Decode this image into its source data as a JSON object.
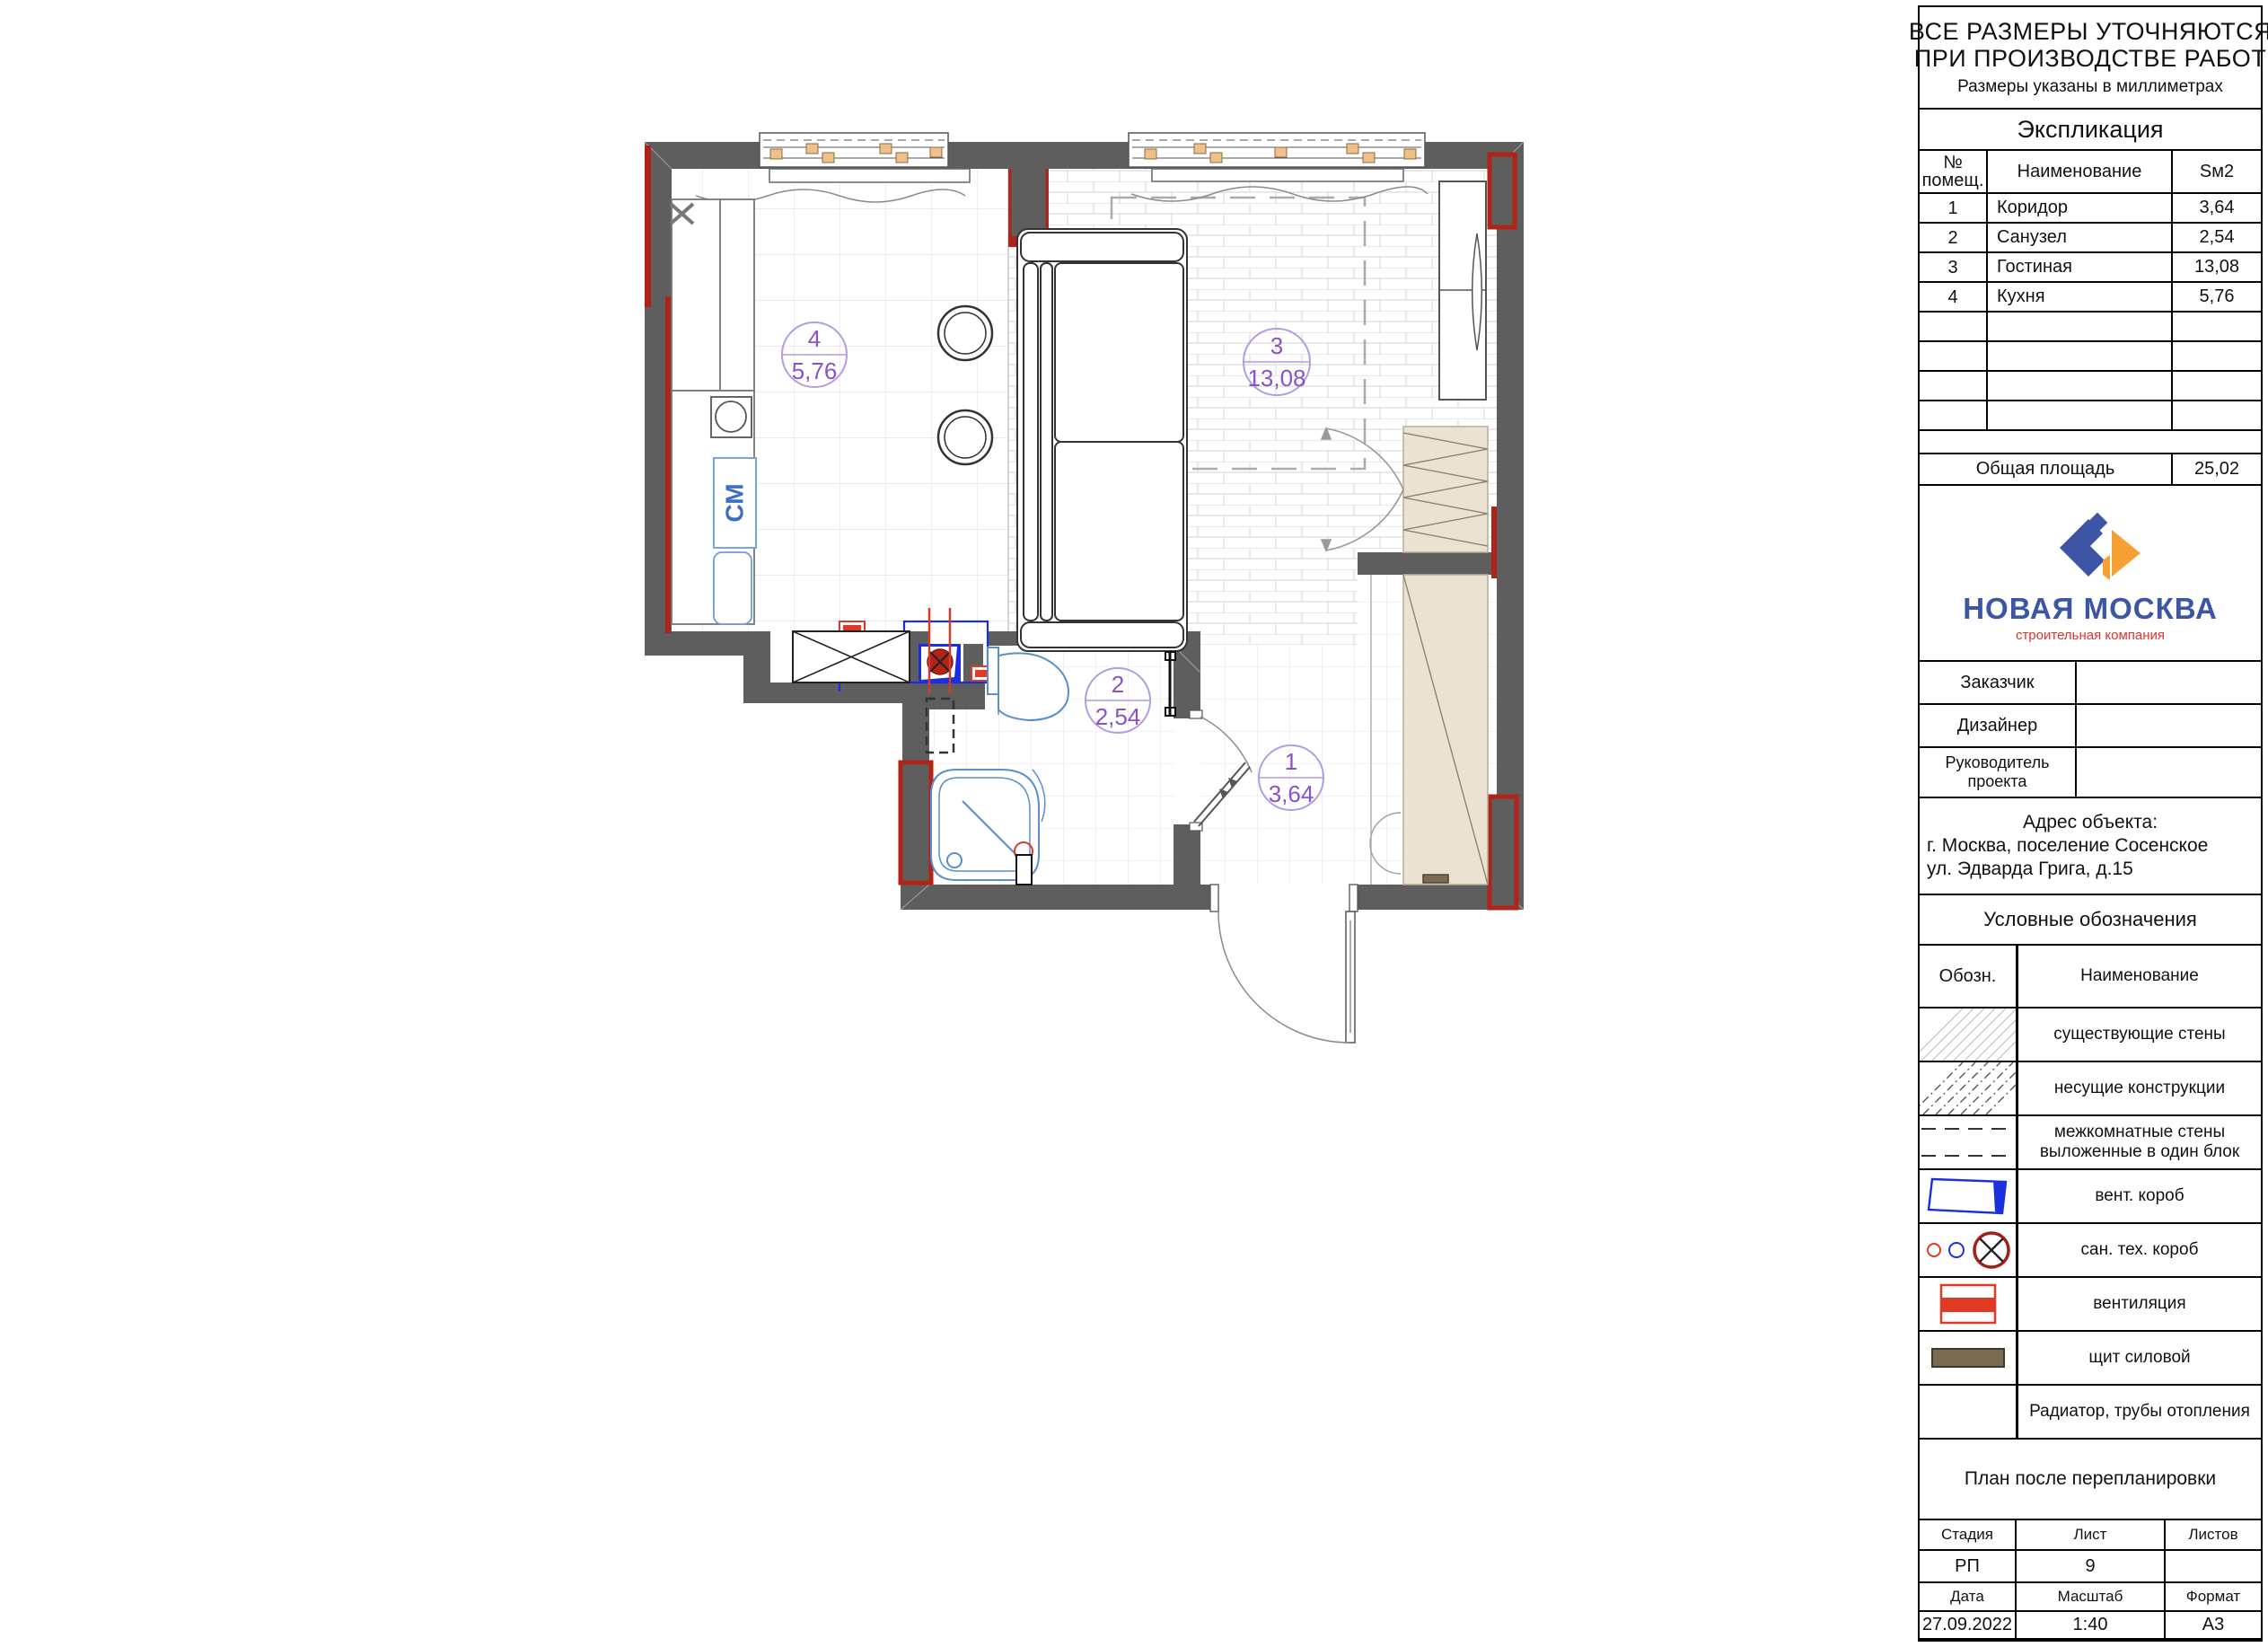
{
  "notice": {
    "line1": "ВСЕ РАЗМЕРЫ УТОЧНЯЮТСЯ",
    "line2": "ПРИ ПРОИЗВОДСТВЕ РАБОТ",
    "subtitle": "Размеры указаны в миллиметрах"
  },
  "explication": {
    "title": "Экспликация",
    "col_num_line1": "№",
    "col_num_line2": "помещ.",
    "col_name": "Наименование",
    "col_area": "Sм2",
    "rows": [
      {
        "num": "1",
        "name": "Коридор",
        "area": "3,64"
      },
      {
        "num": "2",
        "name": "Санузел",
        "area": "2,54"
      },
      {
        "num": "3",
        "name": "Гостиная",
        "area": "13,08"
      },
      {
        "num": "4",
        "name": "Кухня",
        "area": "5,76"
      }
    ],
    "total_label": "Общая площадь",
    "total_value": "25,02"
  },
  "logo": {
    "name": "НОВАЯ МОСКВА",
    "tagline": "строительная компания"
  },
  "form": {
    "customer_label": "Заказчик",
    "designer_label": "Дизайнер",
    "manager_label_line1": "Руководитель",
    "manager_label_line2": "проекта"
  },
  "address": {
    "title": "Адрес объекта:",
    "line1": "г. Москва, поселение Сосенское",
    "line2": "ул. Эдварда Грига, д.15"
  },
  "legend": {
    "title": "Условные обозначения",
    "col_symbol": "Обозн.",
    "col_name": "Наименование",
    "items": [
      {
        "label": "существующие стены"
      },
      {
        "label": "несущие конструкции"
      },
      {
        "label": "межкомнатные стены выложенные в один блок"
      },
      {
        "label": "вент. короб"
      },
      {
        "label": "сан. тех. короб"
      },
      {
        "label": "вентиляция"
      },
      {
        "label": "щит силовой"
      },
      {
        "label": "Радиатор, трубы отопления"
      }
    ]
  },
  "sheet": {
    "plan_title": "План после перепланировки",
    "stage_label": "Стадия",
    "sheet_label": "Лист",
    "sheets_label": "Листов",
    "stage": "РП",
    "sheet_num": "9",
    "sheets": "",
    "date_label": "Дата",
    "scale_label": "Масштаб",
    "format_label": "Формат",
    "date": "27.09.2022",
    "scale": "1:40",
    "format": "А3"
  },
  "plan": {
    "washing_machine_label": "СМ",
    "rooms": [
      {
        "num": "4",
        "area": "5,76"
      },
      {
        "num": "3",
        "area": "13,08"
      },
      {
        "num": "2",
        "area": "2,54"
      },
      {
        "num": "1",
        "area": "3,64"
      }
    ]
  },
  "colors": {
    "wall_gray": "#5e5e5e",
    "pipe_red": "#b02318",
    "vent_red": "#e03a24",
    "duct_blue": "#1b2fe0",
    "fixture_blue": "#5b8fc9",
    "label_purple": "#8a52c8",
    "furniture_tan": "#eae3d3",
    "power_board_brown": "#7b6b52",
    "logo_blue": "#3c55a5",
    "logo_orange": "#f5a033",
    "logo_red": "#e0332c"
  }
}
